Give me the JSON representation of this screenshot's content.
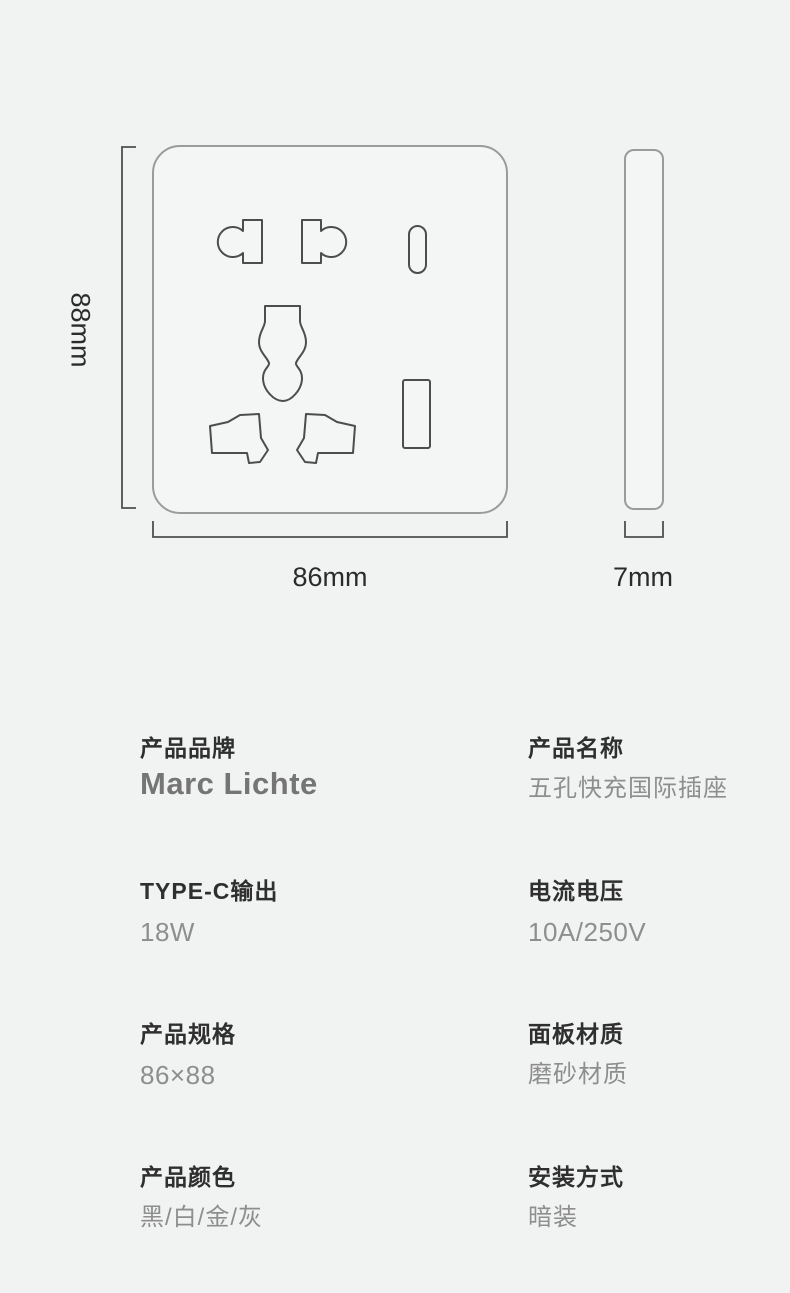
{
  "page": {
    "background_color": "#f1f2f2",
    "outline_color": "#4d4d4d",
    "panel_outline_color": "#9b9b9b",
    "label_color": "#2f2f2f",
    "value_color": "#8e8e8e"
  },
  "diagram": {
    "height_label": "88mm",
    "width_label": "86mm",
    "depth_label": "7mm"
  },
  "specs": [
    {
      "label": "产品品牌",
      "value": "Marc Lichte"
    },
    {
      "label": "产品名称",
      "value": "五孔快充国际插座"
    },
    {
      "label": "TYPE-C输出",
      "value": "18W"
    },
    {
      "label": "电流电压",
      "value": "10A/250V"
    },
    {
      "label": "产品规格",
      "value": "86×88"
    },
    {
      "label": "面板材质",
      "value": "磨砂材质"
    },
    {
      "label": "产品颜色",
      "value": "黑/白/金/灰"
    },
    {
      "label": "安装方式",
      "value": "暗装"
    }
  ]
}
